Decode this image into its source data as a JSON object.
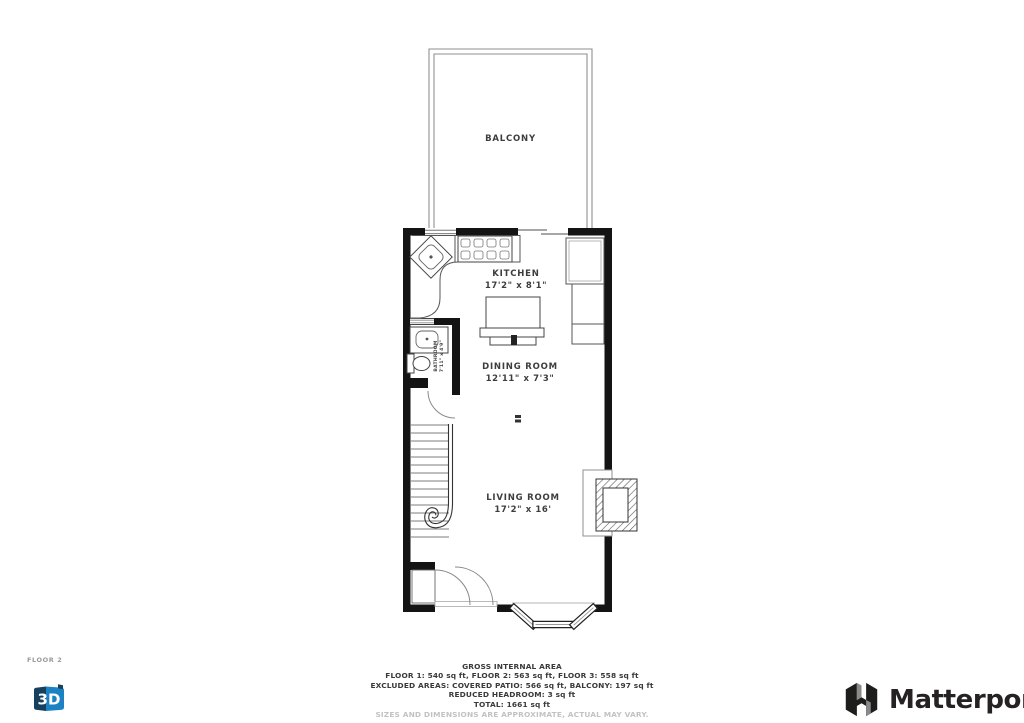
{
  "floor_label": "FLOOR 2",
  "rooms": {
    "balcony": {
      "name": "BALCONY"
    },
    "kitchen": {
      "name": "KITCHEN",
      "dims": "17'2\" x 8'1\""
    },
    "dining_room": {
      "name": "DINING ROOM",
      "dims": "12'11\" x 7'3\""
    },
    "living_room": {
      "name": "LIVING ROOM",
      "dims": "17'2\" x 16'"
    },
    "bathroom": {
      "name": "BATHROOM",
      "dims": "7'11\" x 4'9\""
    }
  },
  "footer": {
    "title": "GROSS INTERNAL AREA",
    "floors": "FLOOR 1: 540 sq ft, FLOOR 2: 563 sq ft, FLOOR 3: 558 sq ft",
    "excluded": "EXCLUDED AREAS: COVERED PATIO: 566 sq ft, BALCONY: 197 sq ft",
    "reduced": "REDUCED HEADROOM: 3 sq ft",
    "total": "TOTAL: 1661 sq ft",
    "disclaimer": "SIZES AND DIMENSIONS ARE APPROXIMATE, ACTUAL MAY VARY."
  },
  "branding": {
    "logo_text": "Matterport",
    "logo_icon": "matterport-m-flag-icon",
    "view_3d_label": "3D",
    "view_3d_icon": "3d-cube-icon"
  },
  "colors": {
    "wall": "#141414",
    "thin_line": "#8a8a8a",
    "label_text": "#3d3d3d",
    "footer_text": "#3a3a3a",
    "disclaimer_text": "#c2c2c2",
    "cube_dark_blue": "#16405e",
    "cube_light_blue": "#1d82c4",
    "logo_text_color": "#262223"
  }
}
